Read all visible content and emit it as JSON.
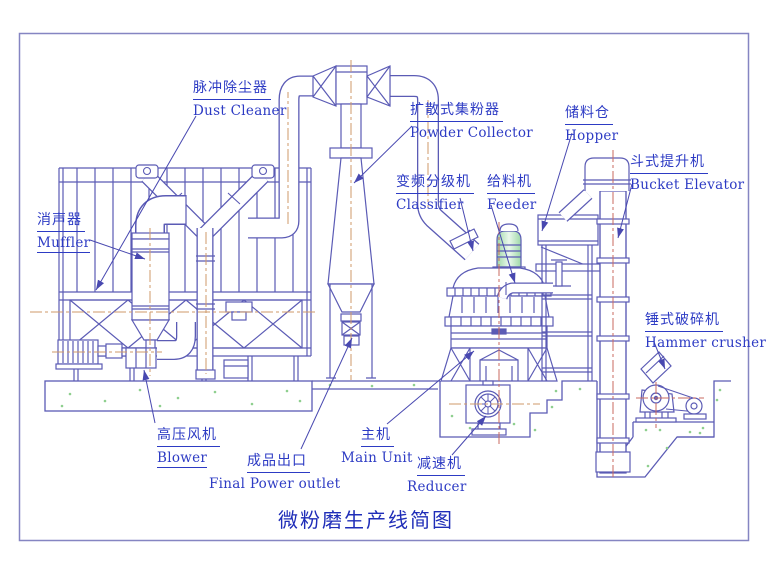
{
  "title": "微粉磨生产线简图",
  "labels": {
    "dust_cleaner": {
      "zh": "脉冲除尘器",
      "en": "Dust Cleaner"
    },
    "powder_collector": {
      "zh": "扩散式集粉器",
      "en": "Powder Collector"
    },
    "hopper": {
      "zh": "储料仓",
      "en": "Hopper"
    },
    "bucket_elevator": {
      "zh": "斗式提升机",
      "en": "Bucket Elevator"
    },
    "classifier": {
      "zh": "变频分级机",
      "en": "Classifier"
    },
    "feeder": {
      "zh": "给料机",
      "en": "Feeder"
    },
    "muffler": {
      "zh": "消声器",
      "en": "Muffler"
    },
    "hammer_crusher": {
      "zh": "锤式破碎机",
      "en": "Hammer crusher"
    },
    "blower": {
      "zh": "高压风机",
      "en": "Blower"
    },
    "final_outlet": {
      "zh": "成品出口",
      "en": "Final Power outlet"
    },
    "main_unit": {
      "zh": "主机",
      "en": "Main Unit"
    },
    "reducer": {
      "zh": "减速机",
      "en": "Reducer"
    }
  },
  "colors": {
    "line": "#5b5bb5",
    "label_text": "#2d3bc4",
    "centerline_tan": "#cf9a6a",
    "centerline_red": "#c96a5f",
    "concrete_speckle": "#8ecf8e",
    "border": "#8585c2"
  }
}
